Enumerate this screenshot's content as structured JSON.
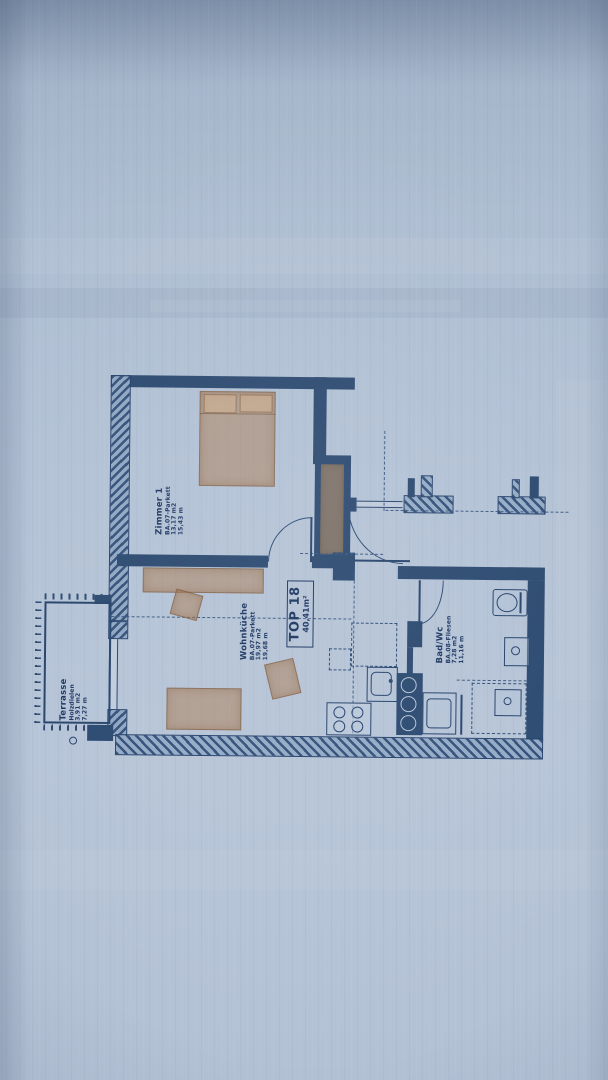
{
  "photo": {
    "paper_color": "#b2c1d5",
    "ink_color": "#27436b",
    "furniture_color": "rgba(170,120,76,0.50)"
  },
  "plan": {
    "unit": {
      "title": "TOP 18",
      "area": "40,41m²"
    },
    "rooms": [
      {
        "name": "Zimmer 1",
        "lines": [
          "BA.07-Parkett",
          "13,17 m2",
          "15,43 m"
        ]
      },
      {
        "name": "Wohnküche",
        "lines": [
          "BA.07-Parkett",
          "19,97 m2",
          "19,68 m"
        ]
      },
      {
        "name": "Bad/Wc",
        "lines": [
          "BA.08-Fliesen",
          "7,28 m2",
          "11,16 m"
        ]
      },
      {
        "name": "Terrasse",
        "lines": [
          "Holzdielen",
          "3,91 m2",
          "7,27 m"
        ]
      }
    ]
  }
}
